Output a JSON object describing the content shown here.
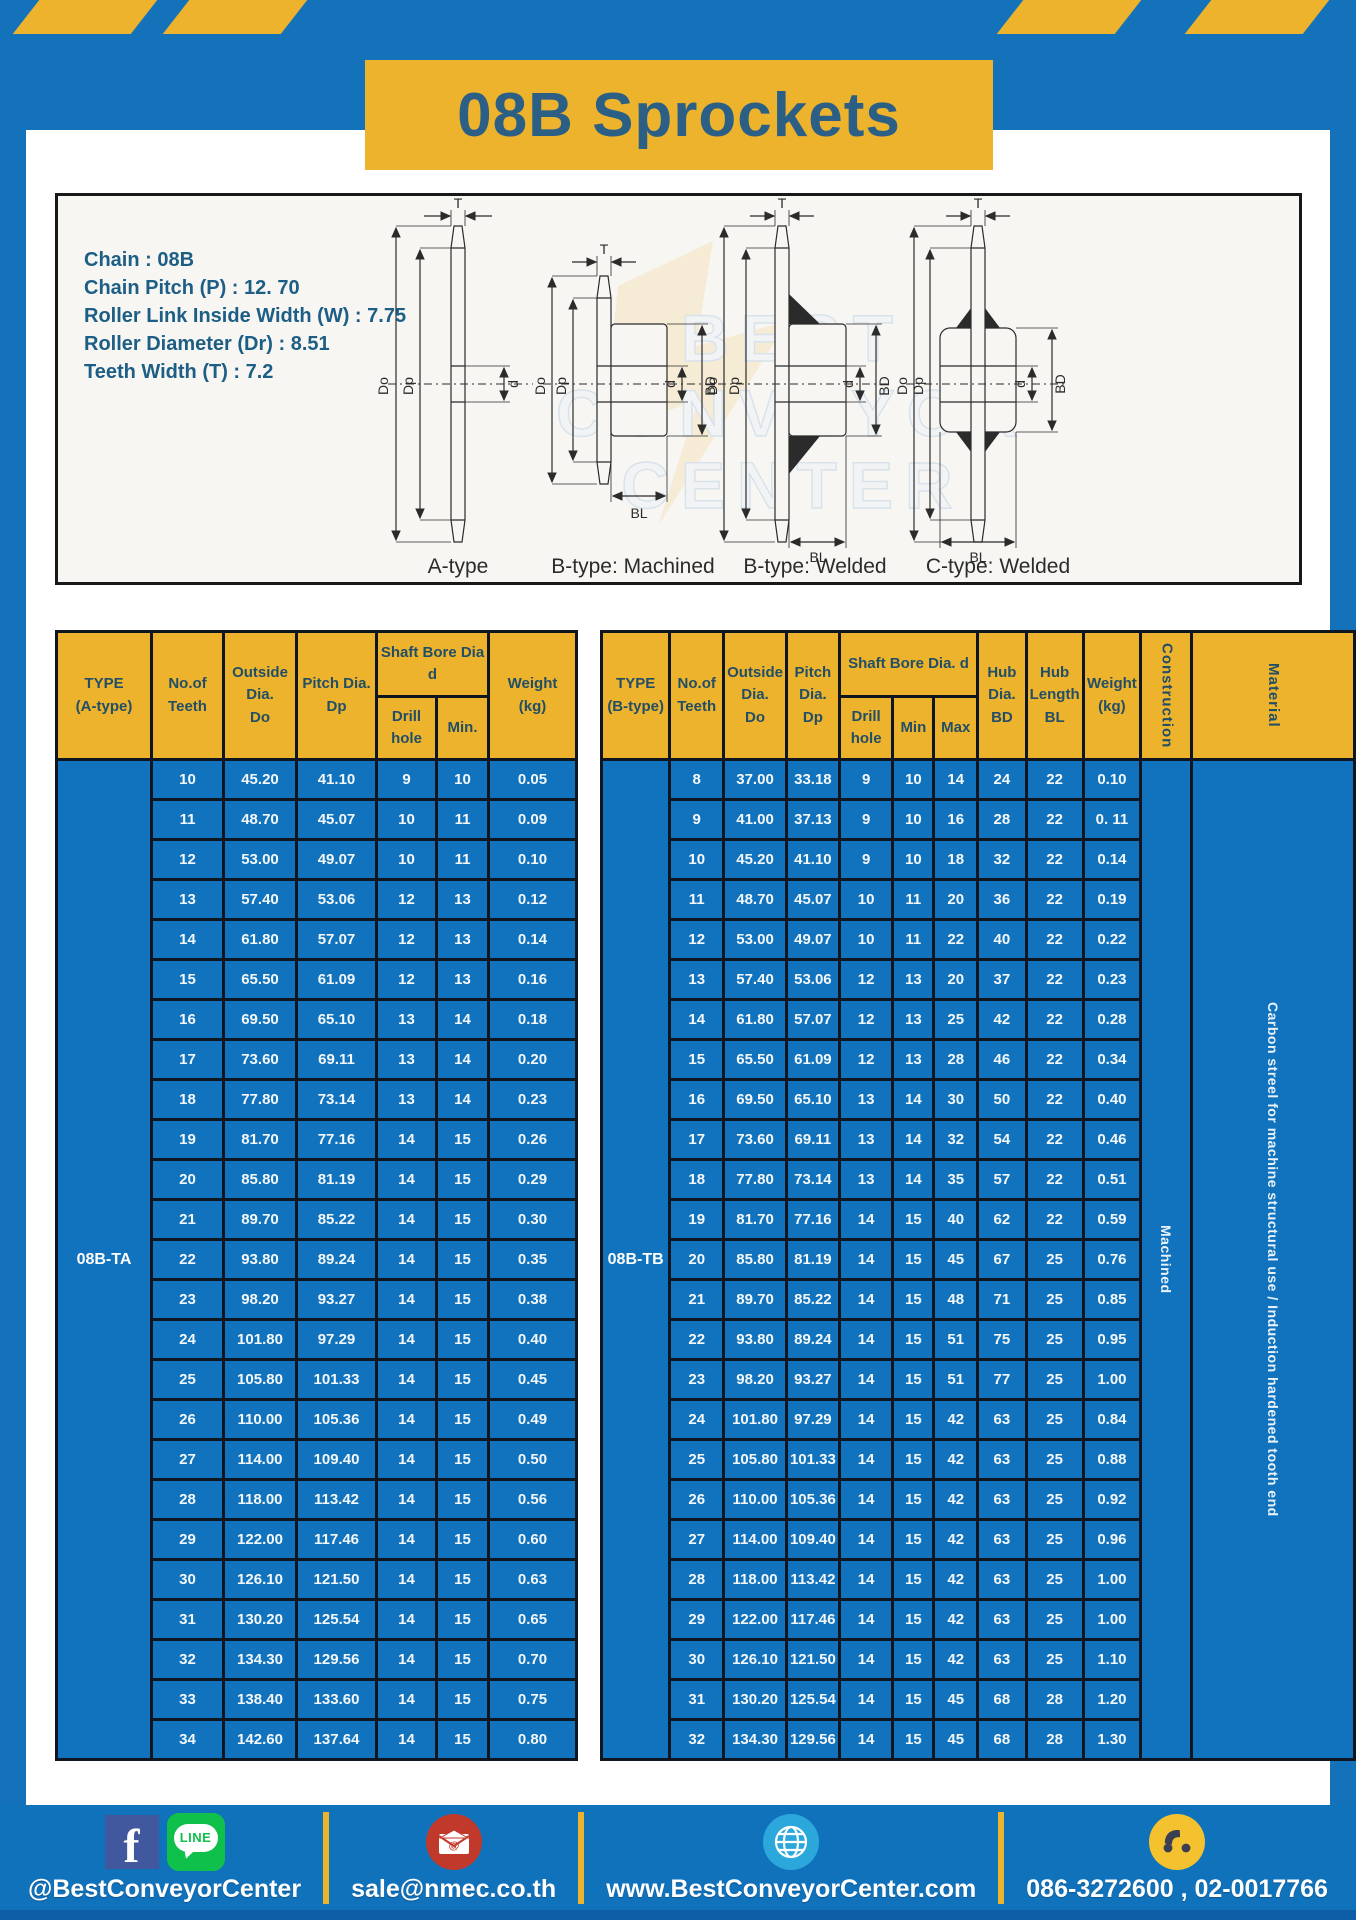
{
  "title": "08B Sprockets",
  "specs": [
    "Chain  : 08B",
    "Chain Pitch (P)  :  12. 70",
    "Roller Link Inside Width (W)  :  7.75",
    "Roller Diameter (Dr)  : 8.51",
    "Teeth Width (T)  :  7.2"
  ],
  "diagram": {
    "captions": [
      "A-type",
      "B-type: Machined",
      "B-type: Welded",
      "C-type: Welded"
    ],
    "dims": {
      "t": "T",
      "do": "Do",
      "dp": "Dp",
      "d": "d",
      "bd": "BD",
      "bl": "BL"
    },
    "watermark": [
      "BEST",
      "CONVEYOR",
      "CENTER"
    ]
  },
  "tableA": {
    "headers": {
      "type": "TYPE\n(A-type)",
      "teeth": "No.of\nTeeth",
      "outside": "Outside\nDia.\nDo",
      "pitch": "Pitch Dia.\nDp",
      "shaft": "Shaft Bore Dia d",
      "drill": "Drill hole",
      "min": "Min.",
      "weight": "Weight\n(kg)"
    },
    "type_label": "08B-TA",
    "rows": [
      [
        "10",
        "45.20",
        "41.10",
        "9",
        "10",
        "0.05"
      ],
      [
        "11",
        "48.70",
        "45.07",
        "10",
        "11",
        "0.09"
      ],
      [
        "12",
        "53.00",
        "49.07",
        "10",
        "11",
        "0.10"
      ],
      [
        "13",
        "57.40",
        "53.06",
        "12",
        "13",
        "0.12"
      ],
      [
        "14",
        "61.80",
        "57.07",
        "12",
        "13",
        "0.14"
      ],
      [
        "15",
        "65.50",
        "61.09",
        "12",
        "13",
        "0.16"
      ],
      [
        "16",
        "69.50",
        "65.10",
        "13",
        "14",
        "0.18"
      ],
      [
        "17",
        "73.60",
        "69.11",
        "13",
        "14",
        "0.20"
      ],
      [
        "18",
        "77.80",
        "73.14",
        "13",
        "14",
        "0.23"
      ],
      [
        "19",
        "81.70",
        "77.16",
        "14",
        "15",
        "0.26"
      ],
      [
        "20",
        "85.80",
        "81.19",
        "14",
        "15",
        "0.29"
      ],
      [
        "21",
        "89.70",
        "85.22",
        "14",
        "15",
        "0.30"
      ],
      [
        "22",
        "93.80",
        "89.24",
        "14",
        "15",
        "0.35"
      ],
      [
        "23",
        "98.20",
        "93.27",
        "14",
        "15",
        "0.38"
      ],
      [
        "24",
        "101.80",
        "97.29",
        "14",
        "15",
        "0.40"
      ],
      [
        "25",
        "105.80",
        "101.33",
        "14",
        "15",
        "0.45"
      ],
      [
        "26",
        "110.00",
        "105.36",
        "14",
        "15",
        "0.49"
      ],
      [
        "27",
        "114.00",
        "109.40",
        "14",
        "15",
        "0.50"
      ],
      [
        "28",
        "118.00",
        "113.42",
        "14",
        "15",
        "0.56"
      ],
      [
        "29",
        "122.00",
        "117.46",
        "14",
        "15",
        "0.60"
      ],
      [
        "30",
        "126.10",
        "121.50",
        "14",
        "15",
        "0.63"
      ],
      [
        "31",
        "130.20",
        "125.54",
        "14",
        "15",
        "0.65"
      ],
      [
        "32",
        "134.30",
        "129.56",
        "14",
        "15",
        "0.70"
      ],
      [
        "33",
        "138.40",
        "133.60",
        "14",
        "15",
        "0.75"
      ],
      [
        "34",
        "142.60",
        "137.64",
        "14",
        "15",
        "0.80"
      ]
    ]
  },
  "tableB": {
    "headers": {
      "type": "TYPE\n(B-type)",
      "teeth": "No.of\nTeeth",
      "outside": "Outside\nDia.\nDo",
      "pitch": "Pitch\nDia.\nDp",
      "shaft": "Shaft Bore Dia.  d",
      "drill": "Drill hole",
      "min": "Min",
      "max": "Max",
      "hub_dia": "Hub\nDia.\nBD",
      "hub_len": "Hub\nLength\nBL",
      "weight": "Weight\n(kg)",
      "construction": "Construction",
      "material": "Material"
    },
    "type_label": "08B-TB",
    "construction_value": "Machined",
    "material_value": "Carbon streel for machine structural use / Induction hardened tooth end",
    "rows": [
      [
        "8",
        "37.00",
        "33.18",
        "9",
        "10",
        "14",
        "24",
        "22",
        "0.10"
      ],
      [
        "9",
        "41.00",
        "37.13",
        "9",
        "10",
        "16",
        "28",
        "22",
        "0. 11"
      ],
      [
        "10",
        "45.20",
        "41.10",
        "9",
        "10",
        "18",
        "32",
        "22",
        "0.14"
      ],
      [
        "11",
        "48.70",
        "45.07",
        "10",
        "11",
        "20",
        "36",
        "22",
        "0.19"
      ],
      [
        "12",
        "53.00",
        "49.07",
        "10",
        "11",
        "22",
        "40",
        "22",
        "0.22"
      ],
      [
        "13",
        "57.40",
        "53.06",
        "12",
        "13",
        "20",
        "37",
        "22",
        "0.23"
      ],
      [
        "14",
        "61.80",
        "57.07",
        "12",
        "13",
        "25",
        "42",
        "22",
        "0.28"
      ],
      [
        "15",
        "65.50",
        "61.09",
        "12",
        "13",
        "28",
        "46",
        "22",
        "0.34"
      ],
      [
        "16",
        "69.50",
        "65.10",
        "13",
        "14",
        "30",
        "50",
        "22",
        "0.40"
      ],
      [
        "17",
        "73.60",
        "69.11",
        "13",
        "14",
        "32",
        "54",
        "22",
        "0.46"
      ],
      [
        "18",
        "77.80",
        "73.14",
        "13",
        "14",
        "35",
        "57",
        "22",
        "0.51"
      ],
      [
        "19",
        "81.70",
        "77.16",
        "14",
        "15",
        "40",
        "62",
        "22",
        "0.59"
      ],
      [
        "20",
        "85.80",
        "81.19",
        "14",
        "15",
        "45",
        "67",
        "25",
        "0.76"
      ],
      [
        "21",
        "89.70",
        "85.22",
        "14",
        "15",
        "48",
        "71",
        "25",
        "0.85"
      ],
      [
        "22",
        "93.80",
        "89.24",
        "14",
        "15",
        "51",
        "75",
        "25",
        "0.95"
      ],
      [
        "23",
        "98.20",
        "93.27",
        "14",
        "15",
        "51",
        "77",
        "25",
        "1.00"
      ],
      [
        "24",
        "101.80",
        "97.29",
        "14",
        "15",
        "42",
        "63",
        "25",
        "0.84"
      ],
      [
        "25",
        "105.80",
        "101.33",
        "14",
        "15",
        "42",
        "63",
        "25",
        "0.88"
      ],
      [
        "26",
        "110.00",
        "105.36",
        "14",
        "15",
        "42",
        "63",
        "25",
        "0.92"
      ],
      [
        "27",
        "114.00",
        "109.40",
        "14",
        "15",
        "42",
        "63",
        "25",
        "0.96"
      ],
      [
        "28",
        "118.00",
        "113.42",
        "14",
        "15",
        "42",
        "63",
        "25",
        "1.00"
      ],
      [
        "29",
        "122.00",
        "117.46",
        "14",
        "15",
        "42",
        "63",
        "25",
        "1.00"
      ],
      [
        "30",
        "126.10",
        "121.50",
        "14",
        "15",
        "42",
        "63",
        "25",
        "1.10"
      ],
      [
        "31",
        "130.20",
        "125.54",
        "14",
        "15",
        "45",
        "68",
        "28",
        "1.20"
      ],
      [
        "32",
        "134.30",
        "129.56",
        "14",
        "15",
        "45",
        "68",
        "28",
        "1.30"
      ]
    ]
  },
  "footer": {
    "fb_letter": "f",
    "line_text": "LINE",
    "facebook_label": "@BestConveyorCenter",
    "email": "sale@nmec.co.th",
    "website": "www.BestConveyorCenter.com",
    "phone": "086-3272600 , 02-0017766"
  },
  "colors": {
    "page_blue": "#1472ba",
    "table_blue": "#1173bd",
    "accent_yellow": "#edb32d",
    "title_text": "#2b5f86"
  }
}
